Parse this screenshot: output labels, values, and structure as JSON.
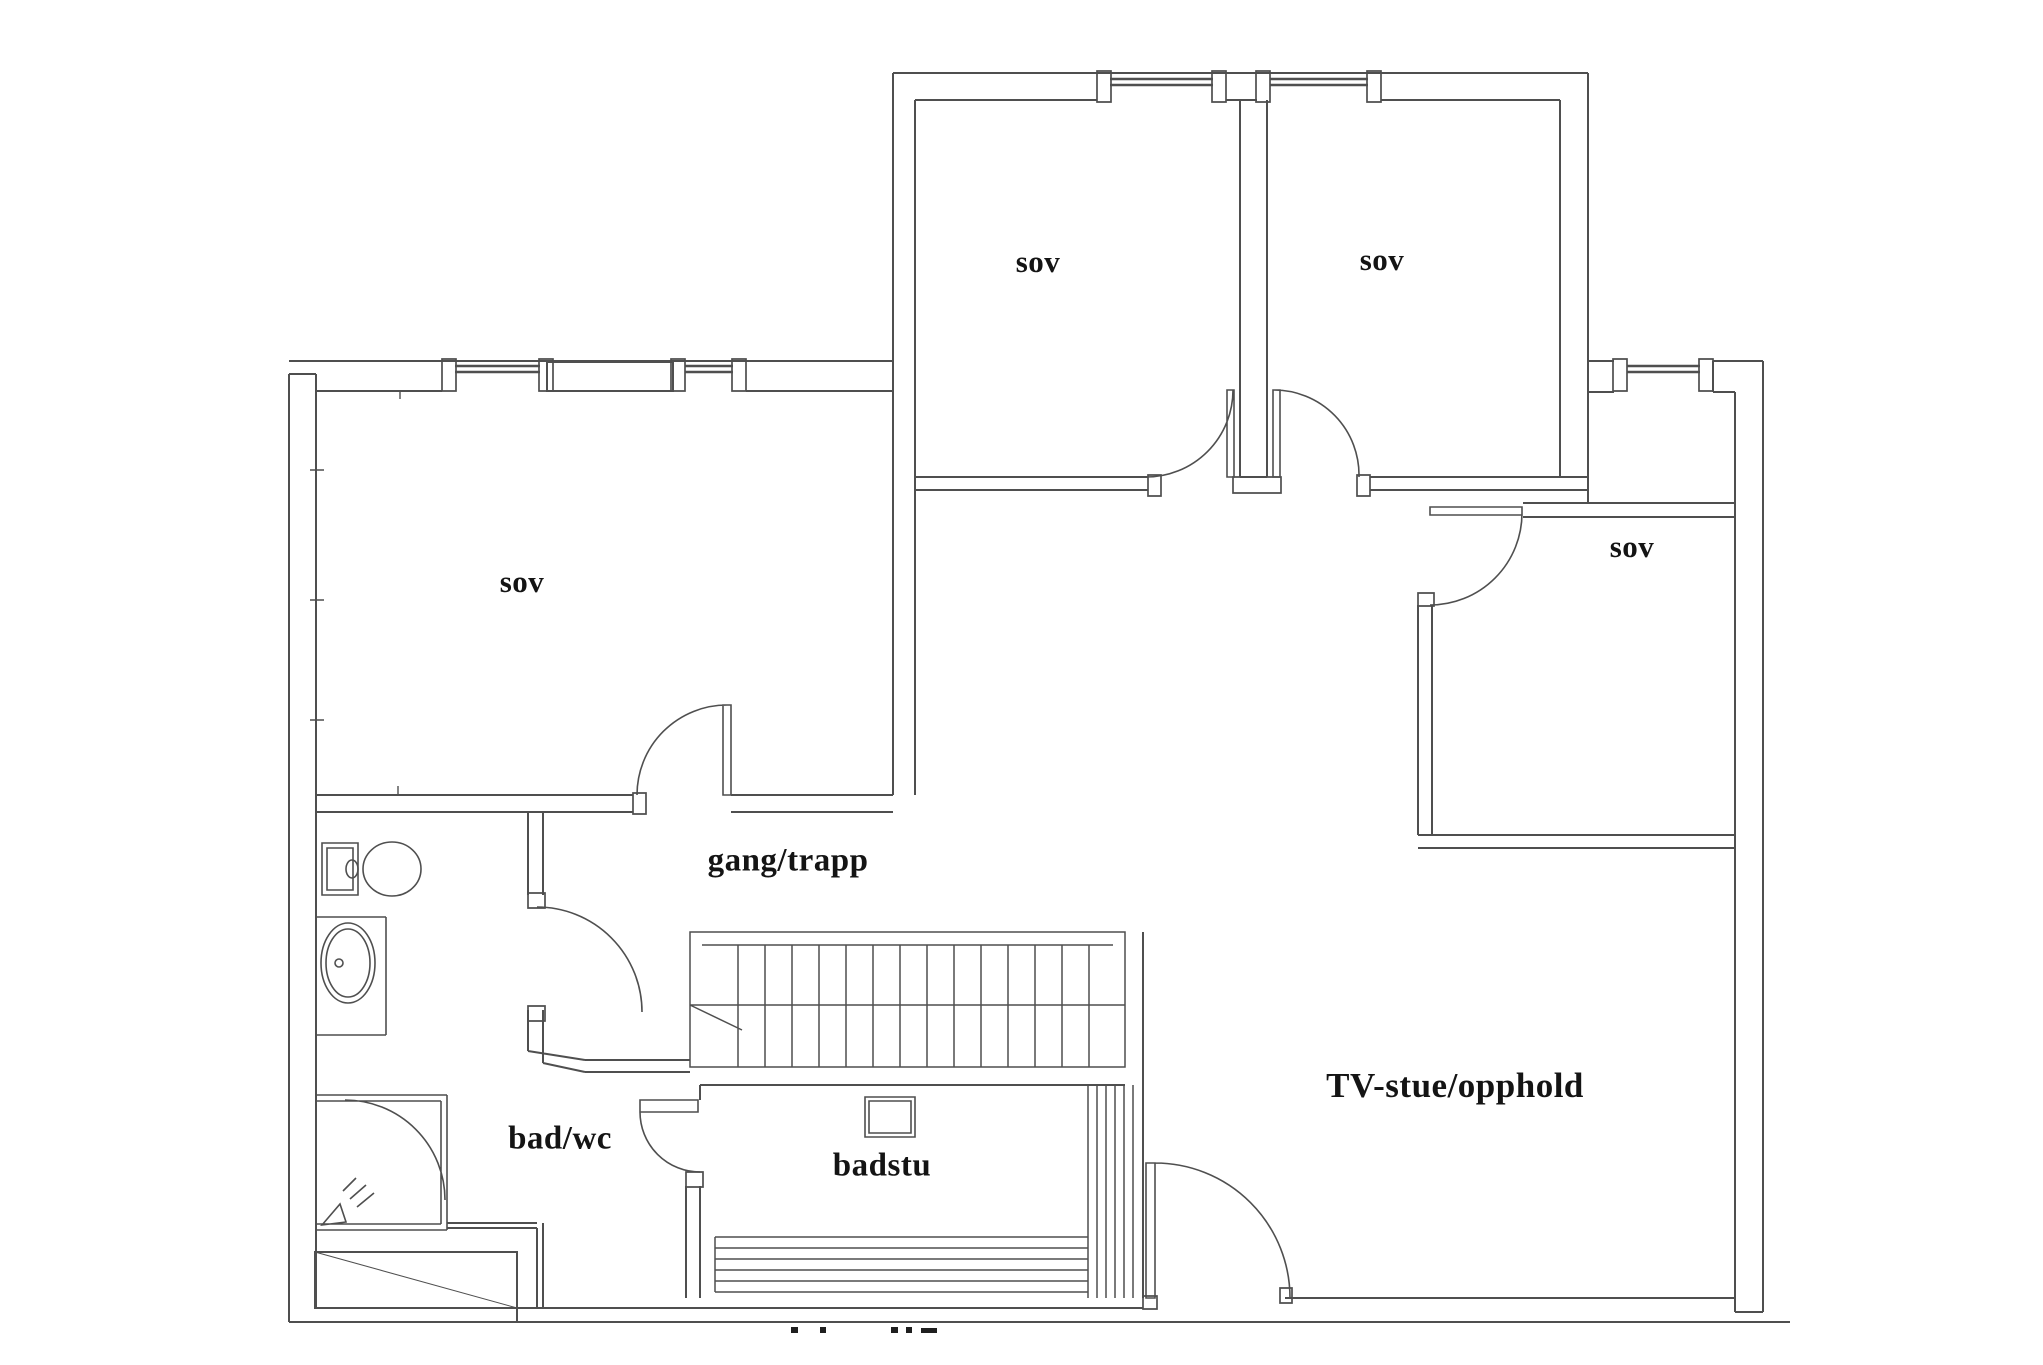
{
  "page": {
    "background_color": "#ffffff",
    "kind": "architectural floor plan drawing"
  },
  "floor_plan": {
    "wall_color": "#4f4f4f",
    "label_color": "#141414",
    "entry_triangle_color": "#0a0a0a",
    "rooms": [
      {
        "id": "sov-left",
        "label": "sov"
      },
      {
        "id": "sov-top-middle",
        "label": "sov"
      },
      {
        "id": "sov-top-right",
        "label": "sov"
      },
      {
        "id": "sov-right",
        "label": "sov"
      },
      {
        "id": "gang-trapp",
        "label": "gang/trapp"
      },
      {
        "id": "bad-wc",
        "label": "bad/wc"
      },
      {
        "id": "badstu",
        "label": "badstu"
      },
      {
        "id": "tv-stue",
        "label": "TV-stue/opphold"
      }
    ],
    "fixtures": [
      {
        "name": "toilet-icon"
      },
      {
        "name": "washbasin-icon"
      },
      {
        "name": "shower-icon"
      },
      {
        "name": "staircase-icon"
      },
      {
        "name": "sauna-stove-icon"
      },
      {
        "name": "sauna-bench-icon"
      },
      {
        "name": "window-icon"
      },
      {
        "name": "door-swing-icon"
      }
    ]
  }
}
